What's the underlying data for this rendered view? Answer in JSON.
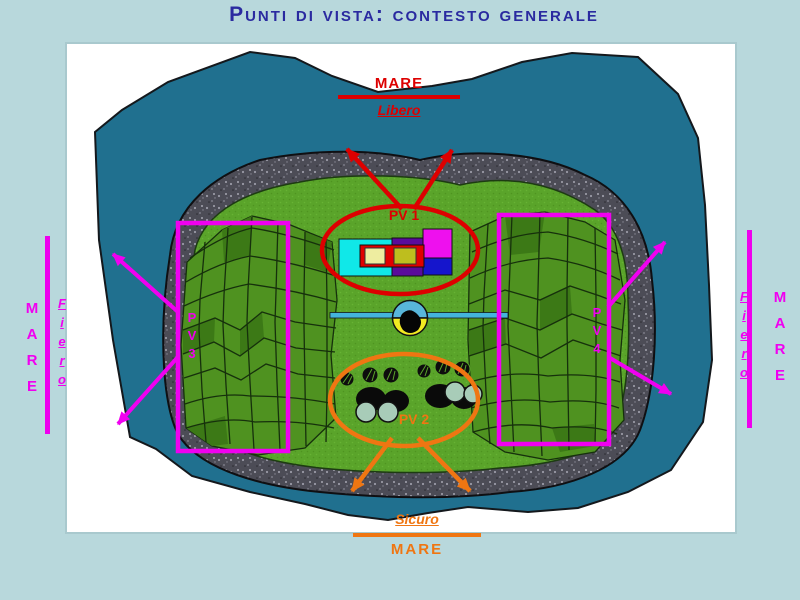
{
  "slide": {
    "title": "Punti di vista: contesto generale"
  },
  "labels": {
    "top": {
      "mare": "MARE",
      "quality": "Libero"
    },
    "bottom": {
      "quality": "Sicuro",
      "mare": "MARE"
    },
    "left": {
      "mare": "MARE",
      "quality": "Fiero"
    },
    "right": {
      "quality": "Fiero",
      "mare": "MARE"
    }
  },
  "viewpoints": [
    {
      "id": "pv1",
      "label": "PV 1",
      "color": "#dd0000"
    },
    {
      "id": "pv2",
      "label": "PV 2",
      "color": "#ef7612"
    },
    {
      "id": "pv3",
      "label": "PV3",
      "color": "#f000f0"
    },
    {
      "id": "pv4",
      "label": "PV4",
      "color": "#f000f0"
    }
  ],
  "colors": {
    "background": "#b8d8dc",
    "sea": "#20708f",
    "land": "#5aa42a",
    "gravel": "#52525c",
    "title": "#2a2aa0",
    "red": "#dd0000",
    "orange": "#ef7612",
    "magenta": "#ff00ff"
  }
}
